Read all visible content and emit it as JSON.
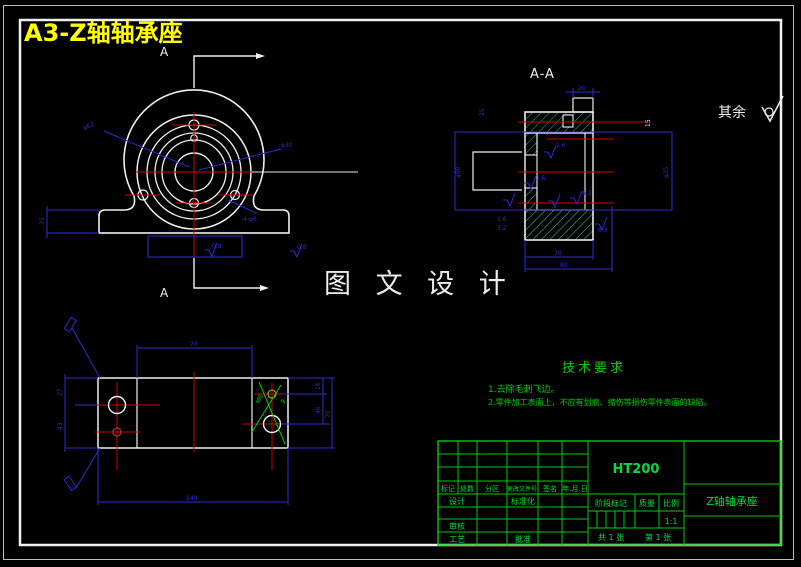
{
  "colors": {
    "background": "#000000",
    "outline_white": "#F0F0F0",
    "centerline_red": "#D00000",
    "dimension_blue": "#2B2BD4",
    "hatch_cyan": "#2EC0B2",
    "annotation_green": "#00CC00",
    "title_yellow": "#FFFF00"
  },
  "header": {
    "title": "A3-Z轴轴承座"
  },
  "watermark": "图 文 设 计",
  "surface_note": {
    "text": "其余"
  },
  "views": {
    "front": {
      "section_label_top": "A",
      "section_label_bottom": "A",
      "dims": {
        "leader_left": "φ62",
        "leader_right": "φ30",
        "leader_holes": "4-φ6",
        "base_height": "25",
        "rough_left": "0.8",
        "rough_right": "0.8"
      }
    },
    "section": {
      "label": "A-A",
      "dims": {
        "top": "20",
        "left_top": "25",
        "left_dia": "φ80",
        "right_dia": "φ35",
        "bore_text": "15",
        "width_inner": "70",
        "width_outer": "80",
        "rough_a": "1.6",
        "rough_b": "3.2",
        "rough_c": "1.6",
        "rough_d": "6.3",
        "rough_e": "1.6",
        "rough_f": "6.3"
      }
    },
    "top": {
      "dims": {
        "top_width": "70",
        "left_upper": "27",
        "left_lower": "43",
        "right_a": "16",
        "right_b": "46",
        "right_c": "70",
        "bottom_width": "140",
        "thread": "M6",
        "hole": "9"
      }
    }
  },
  "tech_req": {
    "title": "技术要求",
    "items": [
      "1.去除毛刺飞边。",
      "2.零件加工表面上，不应有划痕、擦伤等损伤零件表面的缺陷。"
    ]
  },
  "title_block": {
    "material": "HT200",
    "part_name": "Z轴轴承座",
    "scale_value": "1:1",
    "sheet_total": "共 1 张",
    "sheet_no": "第 1 张",
    "labels": {
      "mark": "标记",
      "count": "处数",
      "zone": "分区",
      "change_file_no": "更改文件号",
      "signature": "签名",
      "date": "年.月.日",
      "design": "设计",
      "standardization": "标准化",
      "check": "审核",
      "process": "工艺",
      "approve": "批准",
      "stage_mark": "阶段标记",
      "weight": "质量",
      "scale": "比例"
    }
  }
}
